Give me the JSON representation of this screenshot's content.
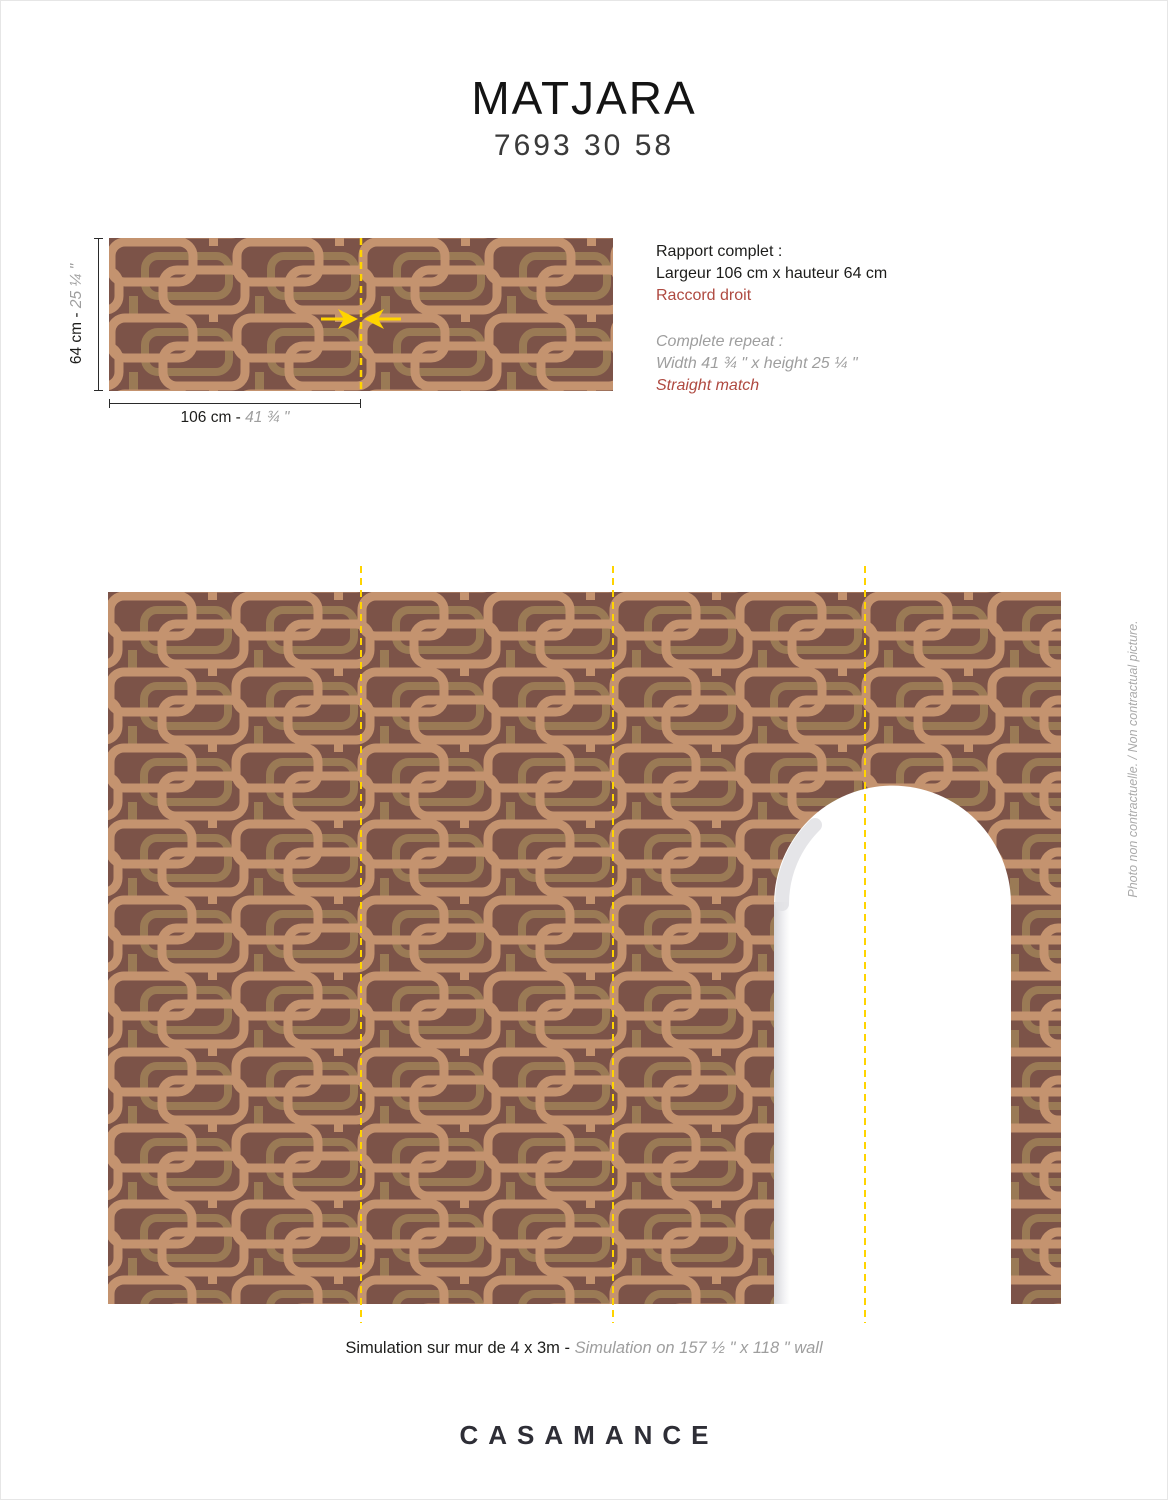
{
  "header": {
    "title": "MATJARA",
    "reference": "7693 30 58"
  },
  "repeat_block": {
    "fr": {
      "heading": "Rapport complet :",
      "size": "Largeur 106 cm x hauteur 64 cm",
      "match": "Raccord droit"
    },
    "en": {
      "heading": "Complete repeat :",
      "size": "Width 41 ¾ \" x height 25 ¼ \"",
      "match": "Straight match"
    }
  },
  "swatch": {
    "height_label_metric": "64 cm - ",
    "height_label_imperial": "25 ¼ \"",
    "width_label_metric": "106 cm - ",
    "width_label_imperial": "41 ¾ \""
  },
  "simulation": {
    "caption_fr": "Simulation sur mur de 4 x 3m - ",
    "caption_en": "Simulation on 157 ½ \" x 118 \" wall"
  },
  "side_note": "Photo non contractuelle. / Non contractual picture.",
  "footer": {
    "brand": "CASAMANCE"
  },
  "colors": {
    "pattern_background": "#7C5348",
    "pattern_light": "#C4936F",
    "pattern_mid": "#9A7A55",
    "repeat_guide_yellow": "#FFD400",
    "match_red": "#AF4A41",
    "secondary_text_gray": "#9E9E9E"
  }
}
